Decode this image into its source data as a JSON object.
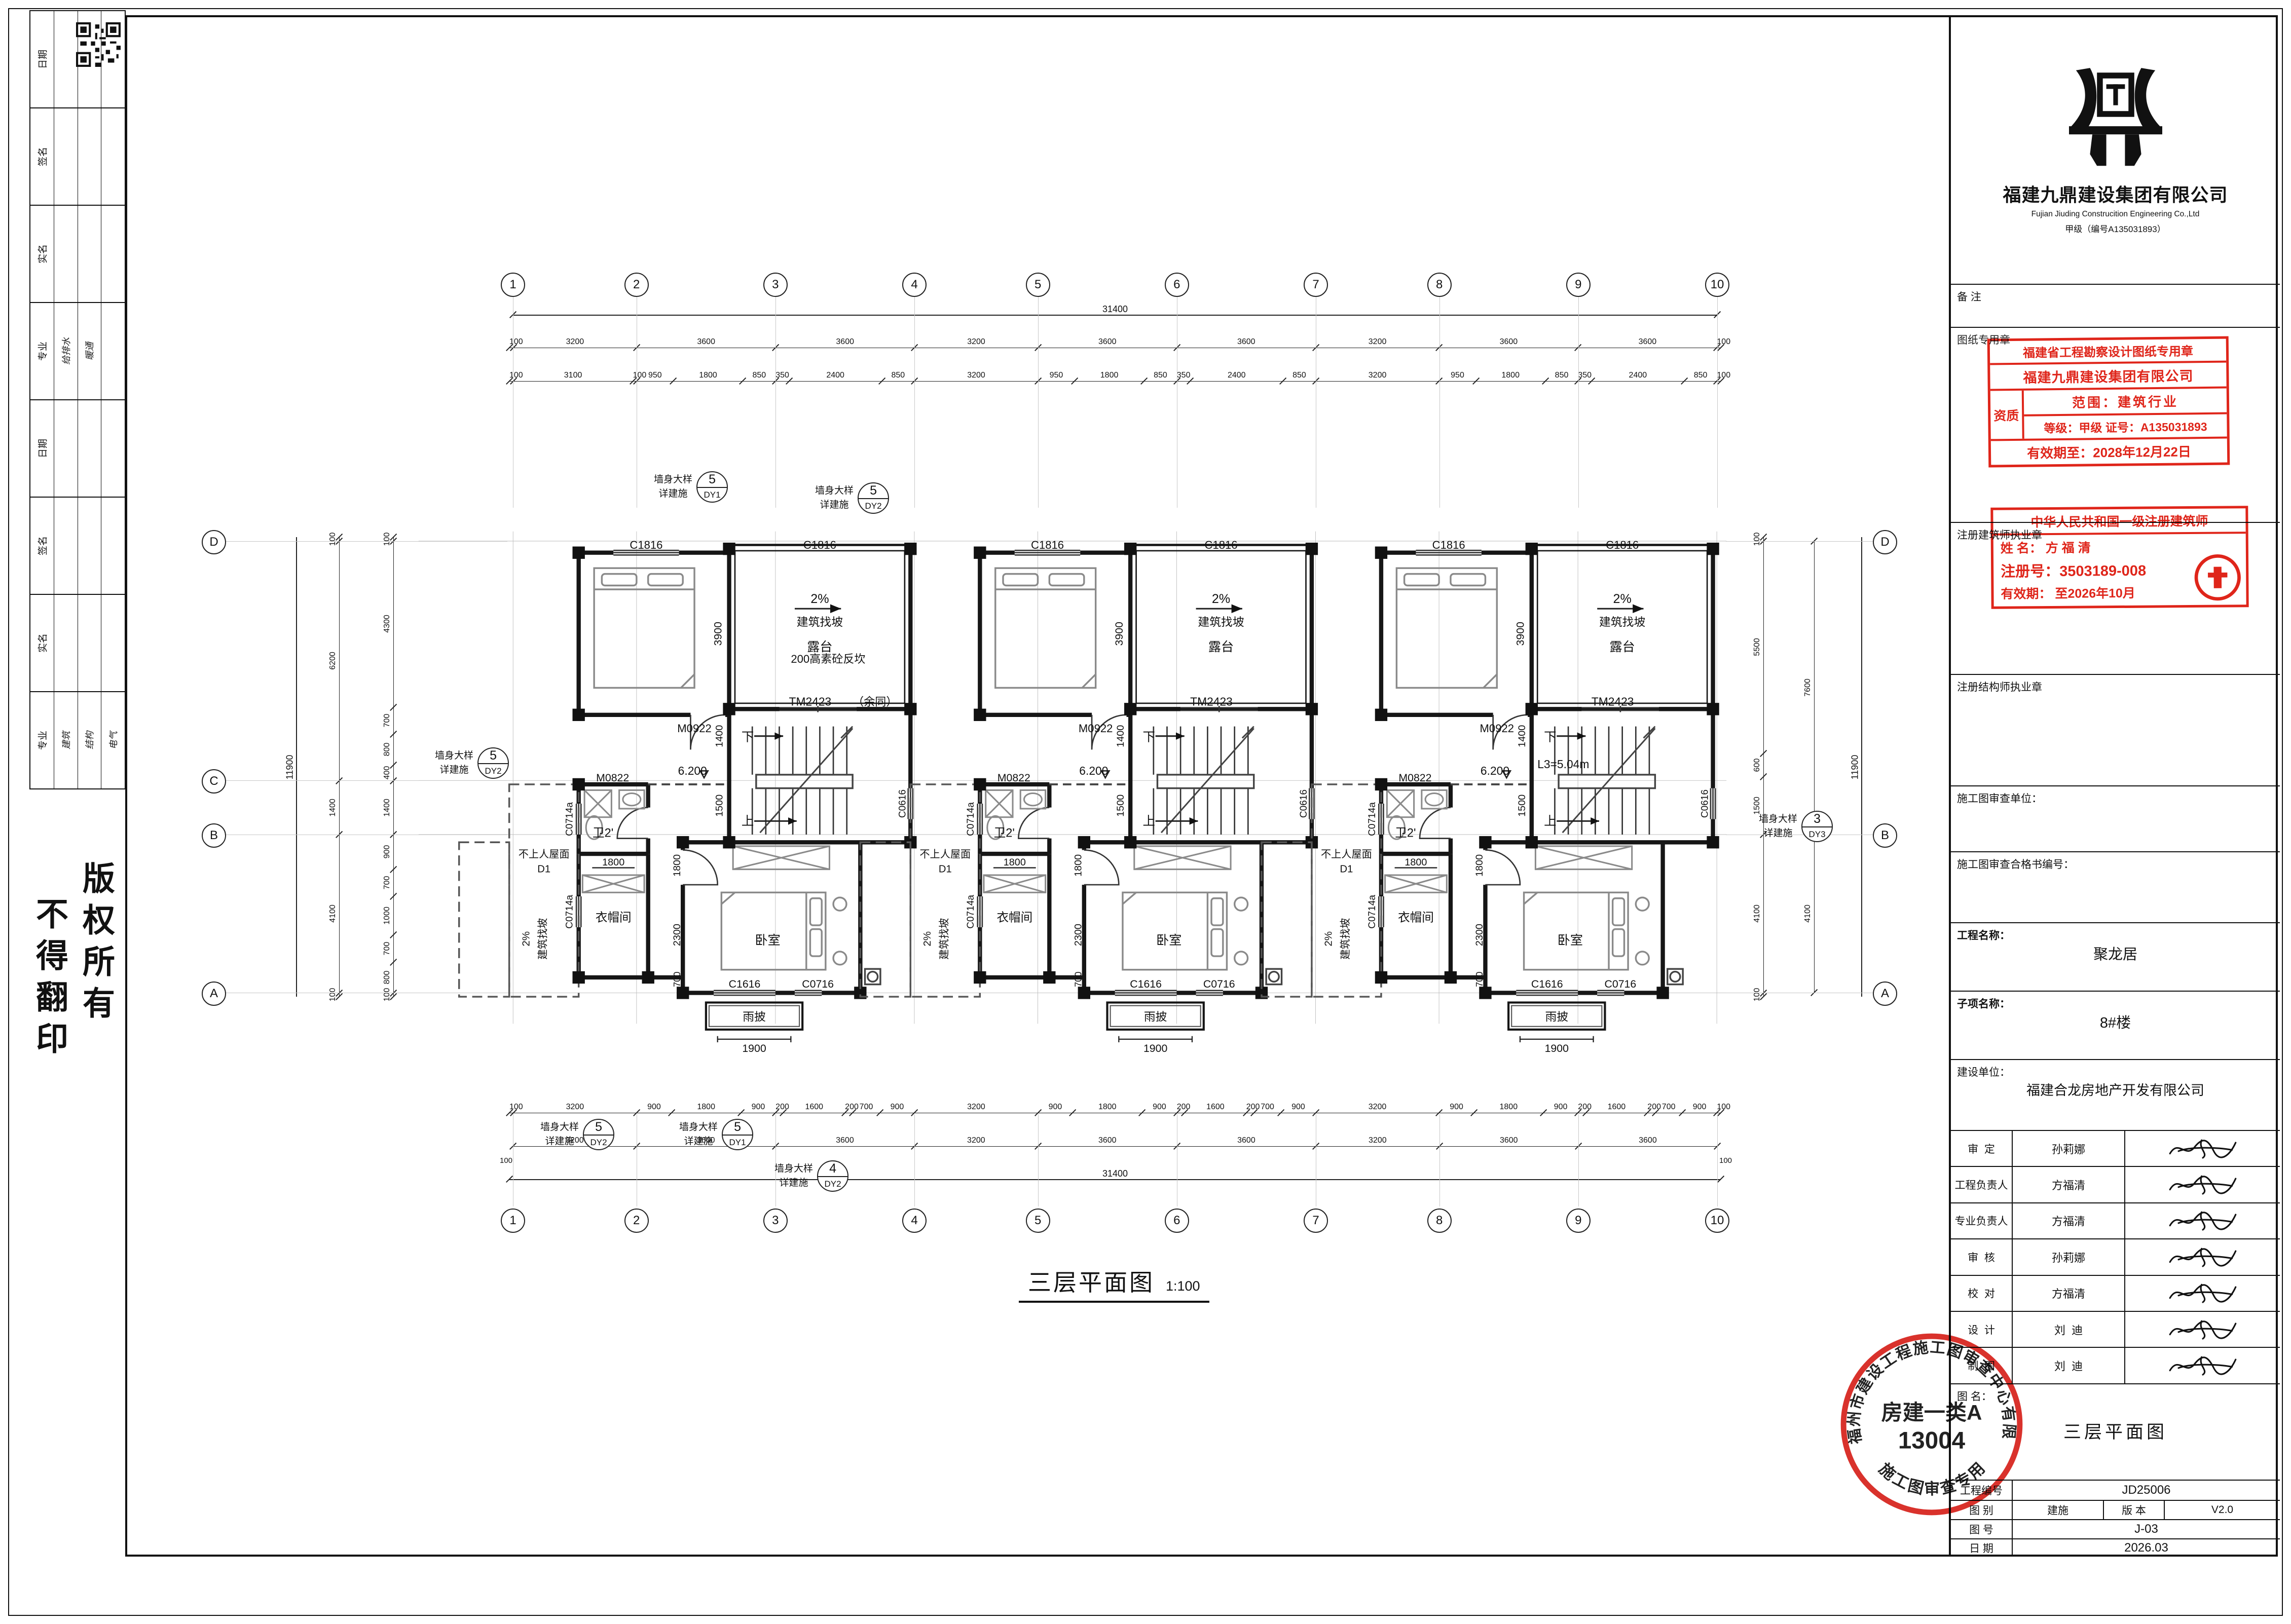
{
  "sheet": {
    "copyright_1": "版权所有",
    "copyright_2": "不得翻印"
  },
  "left_panel": {
    "bands": [
      {
        "label": "日期",
        "e1": "",
        "e2": "",
        "e3": ""
      },
      {
        "label": "签名",
        "e1": "",
        "e2": "",
        "e3": ""
      },
      {
        "label": "实名",
        "e1": "",
        "e2": "",
        "e3": ""
      },
      {
        "label": "专业",
        "e1": "给排水",
        "e2": "暖通",
        "e3": ""
      },
      {
        "label": "日期",
        "e1": "",
        "e2": "",
        "e3": ""
      },
      {
        "label": "签名",
        "e1": "",
        "e2": "",
        "e3": ""
      },
      {
        "label": "实名",
        "e1": "",
        "e2": "",
        "e3": ""
      },
      {
        "label": "专业",
        "e1": "建筑",
        "e2": "结构",
        "e3": "电气"
      }
    ]
  },
  "plan": {
    "title": "三层平面图",
    "scale": "1:100",
    "grid_top": [
      {
        "label": "1",
        "span": 0
      },
      {
        "label": "2",
        "span": 3200
      },
      {
        "label": "3",
        "span": 3600
      },
      {
        "label": "4",
        "span": 3600
      },
      {
        "label": "5",
        "span": 3200
      },
      {
        "label": "6",
        "span": 3600
      },
      {
        "label": "7",
        "span": 3600
      },
      {
        "label": "8",
        "span": 3200
      },
      {
        "label": "9",
        "span": 3600
      },
      {
        "label": "10",
        "span": 3600
      }
    ],
    "grid_left": [
      "D",
      "C",
      "B",
      "A"
    ],
    "grid_right": [
      "D",
      "B",
      "A"
    ],
    "dims": {
      "top_total": "31400",
      "top_row1": [
        "100",
        "3200",
        "3600",
        "3600",
        "3200",
        "3600",
        "3600",
        "3200",
        "3600",
        "3600",
        "100"
      ],
      "top_row2": [
        "100",
        "3100",
        "100",
        "950",
        "1800",
        "850",
        "350",
        "2400",
        "850",
        "3200",
        "950",
        "1800",
        "850",
        "350",
        "2400",
        "850",
        "3200",
        "950",
        "1800",
        "850",
        "350",
        "2400",
        "850",
        "100"
      ],
      "bottom_row1": [
        "100",
        "3200",
        "900",
        "1800",
        "900",
        "200",
        "1600",
        "200",
        "700",
        "900",
        "3200",
        "900",
        "1800",
        "900",
        "200",
        "1600",
        "200",
        "700",
        "900",
        "3200",
        "900",
        "1800",
        "900",
        "200",
        "1600",
        "200",
        "700",
        "900",
        "100"
      ],
      "bottom_row2": [
        "3200",
        "3600",
        "3600",
        "3200",
        "3600",
        "3600",
        "3200",
        "3600",
        "3600"
      ],
      "bottom_total": "31400",
      "left_outer": [
        "100",
        "6200",
        "1400",
        "4100",
        "100"
      ],
      "left_inner": [
        "100",
        "4300",
        "700",
        "800",
        "400",
        "1400",
        "900",
        "700",
        "1000",
        "700",
        "800",
        "100"
      ],
      "left_total": "11900",
      "right_inner": [
        "100",
        "5500",
        "600",
        "1500",
        "4100",
        "100"
      ],
      "right_mid": [
        "7600",
        "4100"
      ],
      "right_total": "11900",
      "end_cap": "100"
    },
    "unit": {
      "win_c1816": "C1816",
      "slope_pct": "2%",
      "slope_note": "建筑找坡",
      "terrace": "露台",
      "door_tm": "TM2423",
      "door_m0922": "M0922",
      "door_m0822": "M0822",
      "level": "6.200",
      "dim_1400": "1400",
      "dim_1500": "1500",
      "dim_3900": "3900",
      "dim_1800": "1800",
      "dim_2300": "2300",
      "dim_700": "700",
      "bath": "卫2'",
      "closet": "衣帽间",
      "closet_dim": "1800",
      "bedroom": "卧室",
      "win_c1616": "C1616",
      "win_c0716": "C0716",
      "win_c0714": "C0714a",
      "win_c0616": "C0616",
      "canopy": "雨披",
      "canopy_dim": "1900",
      "up": "上",
      "down": "下"
    },
    "roof": {
      "label": "不上人屋面",
      "tag": "D1",
      "slope": "2%",
      "slope_note": "建筑找坡"
    },
    "notes": {
      "upstand": "200高素砼反坎",
      "upstand2": "（余同）",
      "stair_len": "L3=5.04m"
    },
    "callouts": {
      "note1": "墙身大样",
      "note2": "详建施",
      "t1": {
        "num": "5",
        "code": "DY1"
      },
      "t2": {
        "num": "5",
        "code": "DY2"
      },
      "l1": {
        "num": "5",
        "code": "DY2"
      },
      "r1": {
        "num": "3",
        "code": "DY3"
      },
      "b1": {
        "num": "5",
        "code": "DY2"
      },
      "b2": {
        "num": "5",
        "code": "DY1"
      },
      "b3": {
        "num": "4",
        "code": "DY2"
      }
    }
  },
  "title_block": {
    "company_cn": "福建九鼎建设集团有限公司",
    "company_en": "Fujian Jiuding Construcition Engineering Co.,Ltd",
    "grade_line": "甲级（编号A135031893）",
    "remark": "备 注",
    "sheet_seal_label": "图纸专用章",
    "arch_seal_label": "注册建筑师执业章",
    "struct_seal_label": "注册结构师执业章",
    "review_unit": "施工图审查单位：",
    "review_no": "施工图审查合格书编号：",
    "project_label": "工程名称：",
    "project_value": "聚龙居",
    "sub_label": "子项名称：",
    "sub_value": "8#楼",
    "client_label": "建设单位：",
    "client_value": "福建合龙房地产开发有限公司",
    "sign_rows": [
      {
        "role": "审  定",
        "name": "孙莉娜"
      },
      {
        "role": "工程负责人",
        "name": "方福清"
      },
      {
        "role": "专业负责人",
        "name": "方福清"
      },
      {
        "role": "审  核",
        "name": "孙莉娜"
      },
      {
        "role": "校  对",
        "name": "方福清"
      },
      {
        "role": "设  计",
        "name": "刘  迪"
      },
      {
        "role": "制  图",
        "name": "刘  迪"
      }
    ],
    "fig_label": "图 名：",
    "fig_value": "三层平面图",
    "eng_no_label": "工程编号",
    "eng_no": "JD25006",
    "type_label": "图  别",
    "type_value": "建施",
    "ver_label": "版  本",
    "ver_value": "V2.0",
    "fig_no_label": "图  号",
    "fig_no": "J-03",
    "date_label": "日  期",
    "date_value": "2026.03"
  },
  "stamps": {
    "seal1": {
      "line1": "福建省工程勘察设计图纸专用章",
      "line2": "福建九鼎建设集团有限公司",
      "qual": "资质",
      "scope": "范围：建筑行业",
      "grade": "等级：甲级 证号：A135031893",
      "valid": "有效期至：2028年12月22日"
    },
    "seal2": {
      "line1": "中华人民共和国一级注册建筑师",
      "name": "姓  名：  方 福 清",
      "reg": "注册号：3503189-008",
      "valid": "有效期：  至2026年10月"
    },
    "seal3": {
      "arc_top": "福州市建设工程施工图审查中心有限公司",
      "center1": "房建一类A",
      "center2": "13004",
      "arc_bottom": "施工图审查专用章"
    }
  }
}
